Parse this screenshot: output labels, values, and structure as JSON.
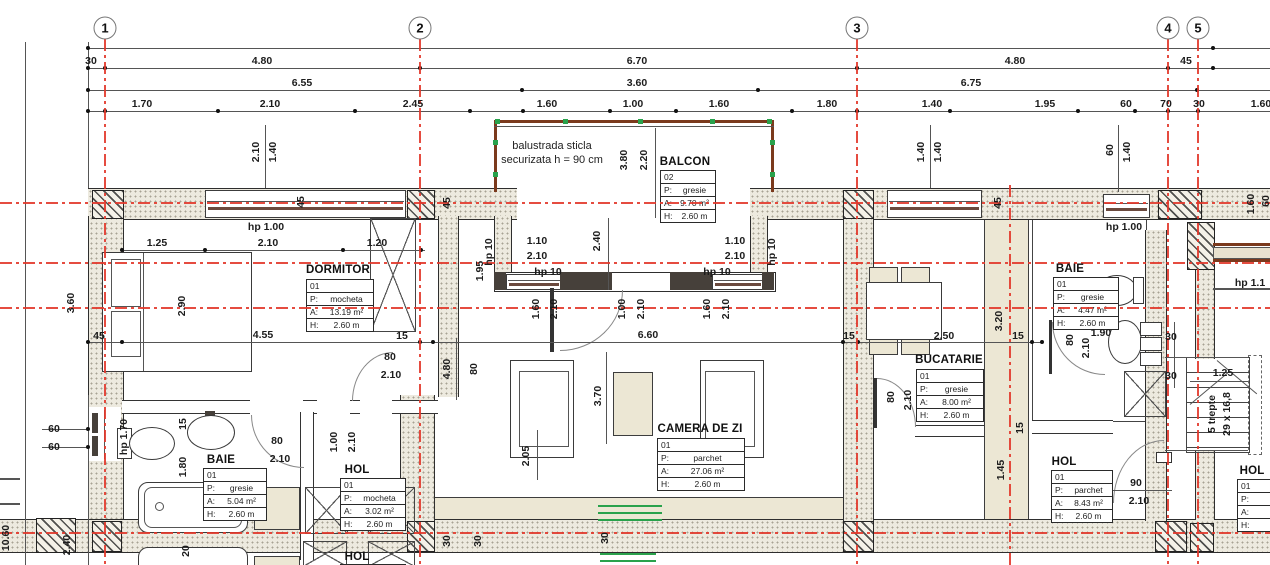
{
  "colors": {
    "axis": "#e2382b",
    "balustrade": "#7b3a1d",
    "green": "#2aa24c",
    "beige": "#ece7d4"
  },
  "grid_bubbles": [
    [
      "1",
      105
    ],
    [
      "2",
      420
    ],
    [
      "3",
      857
    ],
    [
      "4",
      1168
    ],
    [
      "5",
      1198
    ]
  ],
  "axes": {
    "v": [
      {
        "x": 105,
        "t": 39
      },
      {
        "x": 420,
        "t": 39
      },
      {
        "x": 857,
        "t": 39
      },
      {
        "x": 1010,
        "t": 185
      },
      {
        "x": 1168,
        "t": 39
      },
      {
        "x": 1198,
        "t": 39
      }
    ],
    "h": [
      203,
      263,
      308,
      533
    ]
  },
  "dim_rows": [
    {
      "y": 48,
      "dots": [
        88,
        1213
      ],
      "labels": []
    },
    {
      "y": 68,
      "dots": [
        88,
        105,
        420,
        857,
        1168,
        1213
      ],
      "labels": [
        [
          "30",
          91
        ],
        [
          "4.80",
          262
        ],
        [
          "6.70",
          637
        ],
        [
          "4.80",
          1015
        ],
        [
          "45",
          1186
        ]
      ]
    },
    {
      "y": 90,
      "dots": [
        88,
        522,
        758,
        1197
      ],
      "labels": [
        [
          "6.55",
          302
        ],
        [
          "3.60",
          637
        ],
        [
          "6.75",
          971
        ]
      ]
    },
    {
      "y": 111,
      "dots": [
        88,
        105,
        218,
        355,
        470,
        523,
        610,
        676,
        792,
        857,
        950,
        1078,
        1135,
        1168,
        1198
      ],
      "labels": [
        [
          "1.70",
          142
        ],
        [
          "2.10",
          270
        ],
        [
          "2.45",
          413
        ],
        [
          "1.60",
          547
        ],
        [
          "1.00",
          633
        ],
        [
          "1.60",
          719
        ],
        [
          "1.80",
          827
        ],
        [
          "1.40",
          932
        ],
        [
          "1.95",
          1045
        ],
        [
          "60",
          1126
        ],
        [
          "70",
          1166
        ],
        [
          "30",
          1199
        ],
        [
          "1.60",
          1261
        ]
      ]
    }
  ],
  "extra_dots": [
    [
      122,
      250
    ],
    [
      205,
      250
    ],
    [
      343,
      250
    ],
    [
      421,
      250
    ],
    [
      88,
      342
    ],
    [
      122,
      342
    ],
    [
      420,
      342
    ],
    [
      433,
      342
    ],
    [
      843,
      342
    ],
    [
      858,
      342
    ],
    [
      1032,
      342
    ],
    [
      1042,
      342
    ],
    [
      88,
      429
    ],
    [
      88,
      447
    ]
  ],
  "labels": [
    [
      "hp 1.00",
      266,
      227,
      0
    ],
    [
      "hp 1.00",
      1124,
      227,
      0
    ],
    [
      "1.25",
      157,
      243,
      0
    ],
    [
      "2.10",
      268,
      243,
      0
    ],
    [
      "1.20",
      377,
      243,
      0
    ],
    [
      "1.10",
      537,
      241,
      0
    ],
    [
      "2.10",
      537,
      256,
      0
    ],
    [
      "hp 10",
      548,
      272,
      0
    ],
    [
      "1.10",
      735,
      241,
      0
    ],
    [
      "2.10",
      735,
      256,
      0
    ],
    [
      "hp 10",
      717,
      272,
      0
    ],
    [
      "6.60",
      648,
      335,
      0
    ],
    [
      "45",
      99,
      336,
      0
    ],
    [
      "4.55",
      263,
      335,
      0
    ],
    [
      "15",
      402,
      336,
      0
    ],
    [
      "15",
      849,
      336,
      0
    ],
    [
      "2.50",
      944,
      336,
      0
    ],
    [
      "15",
      1018,
      336,
      0
    ],
    [
      "80",
      390,
      357,
      0
    ],
    [
      "2.10",
      391,
      375,
      0
    ],
    [
      "80",
      277,
      441,
      0
    ],
    [
      "2.10",
      280,
      459,
      0
    ],
    [
      "60",
      54,
      429,
      0
    ],
    [
      "60",
      54,
      447,
      0
    ],
    [
      "1.90",
      1101,
      333,
      0
    ],
    [
      "30",
      1171,
      337,
      0
    ],
    [
      "30",
      1171,
      376,
      0
    ],
    [
      "1.25",
      1223,
      373,
      0
    ],
    [
      "90",
      1136,
      483,
      0
    ],
    [
      "2.10",
      1139,
      501,
      0
    ],
    [
      "hp 1.1",
      1250,
      283,
      0
    ],
    [
      "2.10",
      256,
      152,
      1
    ],
    [
      "1.40",
      273,
      152,
      1
    ],
    [
      "3.80",
      624,
      160,
      1
    ],
    [
      "2.20",
      644,
      160,
      1
    ],
    [
      "2.40",
      597,
      241,
      1
    ],
    [
      "1.95",
      480,
      271,
      1
    ],
    [
      "hp 10",
      489,
      252,
      1
    ],
    [
      "hp 10",
      772,
      252,
      1
    ],
    [
      "1.60",
      536,
      309,
      1
    ],
    [
      "2.10",
      554,
      309,
      1
    ],
    [
      "1.00",
      622,
      309,
      1
    ],
    [
      "2.10",
      641,
      309,
      1
    ],
    [
      "1.60",
      707,
      309,
      1
    ],
    [
      "2.10",
      726,
      309,
      1
    ],
    [
      "3.70",
      598,
      396,
      1
    ],
    [
      "4.80",
      447,
      369,
      1
    ],
    [
      "80",
      474,
      369,
      1
    ],
    [
      "2.05",
      526,
      456,
      1
    ],
    [
      "2.90",
      182,
      306,
      1
    ],
    [
      "45",
      301,
      202,
      1
    ],
    [
      "45",
      447,
      203,
      1
    ],
    [
      "45",
      998,
      203,
      1
    ],
    [
      "1.40",
      921,
      152,
      1
    ],
    [
      "1.40",
      938,
      152,
      1
    ],
    [
      "60",
      1110,
      150,
      1
    ],
    [
      "1.40",
      1127,
      152,
      1
    ],
    [
      "1.60",
      1251,
      204,
      1
    ],
    [
      "60",
      1266,
      201,
      1
    ],
    [
      "3.60",
      71,
      303,
      1
    ],
    [
      "2.40",
      67,
      545,
      1
    ],
    [
      "10.60",
      6,
      538,
      1
    ],
    [
      "hp 1.70",
      124,
      437,
      1
    ],
    [
      "15",
      183,
      424,
      1
    ],
    [
      "1.80",
      183,
      467,
      1
    ],
    [
      "20",
      186,
      551,
      1
    ],
    [
      "1.00",
      334,
      442,
      1
    ],
    [
      "2.10",
      352,
      442,
      1
    ],
    [
      "80",
      891,
      397,
      1
    ],
    [
      "2.10",
      908,
      400,
      1
    ],
    [
      "3.20",
      999,
      321,
      1
    ],
    [
      "1.45",
      1001,
      470,
      1
    ],
    [
      "15",
      1020,
      428,
      1
    ],
    [
      "80",
      1070,
      340,
      1
    ],
    [
      "2.10",
      1086,
      348,
      1
    ],
    [
      "5 trepte",
      1212,
      414,
      1
    ],
    [
      "29 x 16,8",
      1227,
      414,
      1
    ],
    [
      "30",
      447,
      541,
      1
    ],
    [
      "30",
      478,
      541,
      1
    ],
    [
      "30",
      605,
      538,
      1
    ]
  ],
  "notes": [
    [
      "balustrada sticla",
      552,
      146
    ],
    [
      "securizata h = 90 cm",
      552,
      160
    ]
  ],
  "rooms": [
    {
      "name": "DORMITOR",
      "nx": 338,
      "ny": 270,
      "tx": 306,
      "ty": 279,
      "w": 66,
      "rows": [
        [
          "01",
          ""
        ],
        [
          "P:",
          "mocheta"
        ],
        [
          "A:",
          "13.19 m²"
        ],
        [
          "H:",
          "2.60 m"
        ]
      ]
    },
    {
      "name": "BALCON",
      "nx": 685,
      "ny": 162,
      "tx": 660,
      "ty": 170,
      "w": 54,
      "rows": [
        [
          "02",
          ""
        ],
        [
          "P:",
          "gresie"
        ],
        [
          "A:",
          "9.70 m²"
        ],
        [
          "H:",
          "2.60 m"
        ]
      ]
    },
    {
      "name": "CAMERA DE ZI",
      "nx": 700,
      "ny": 429,
      "tx": 657,
      "ty": 438,
      "w": 86,
      "rows": [
        [
          "01",
          ""
        ],
        [
          "P:",
          "parchet"
        ],
        [
          "A:",
          "27.06 m²"
        ],
        [
          "H:",
          "2.60 m"
        ]
      ]
    },
    {
      "name": "BUCATARIE",
      "nx": 949,
      "ny": 360,
      "tx": 916,
      "ty": 369,
      "w": 66,
      "rows": [
        [
          "01",
          ""
        ],
        [
          "P:",
          "gresie"
        ],
        [
          "A:",
          "8.00 m²"
        ],
        [
          "H:",
          "2.60 m"
        ]
      ]
    },
    {
      "name": "BAIE",
      "nx": 221,
      "ny": 460,
      "tx": 203,
      "ty": 468,
      "w": 62,
      "rows": [
        [
          "01",
          ""
        ],
        [
          "P:",
          "gresie"
        ],
        [
          "A:",
          "5.04 m²"
        ],
        [
          "H:",
          "2.60 m"
        ]
      ]
    },
    {
      "name": "HOL",
      "nx": 357,
      "ny": 470,
      "tx": 340,
      "ty": 478,
      "w": 64,
      "rows": [
        [
          "01",
          ""
        ],
        [
          "P:",
          "mocheta"
        ],
        [
          "A:",
          "3.02 m²"
        ],
        [
          "H:",
          "2.60 m"
        ]
      ]
    },
    {
      "name": "BAIE",
      "nx": 1070,
      "ny": 269,
      "tx": 1053,
      "ty": 277,
      "w": 64,
      "rows": [
        [
          "01",
          ""
        ],
        [
          "P:",
          "gresie"
        ],
        [
          "A:",
          "4.47 m²"
        ],
        [
          "H:",
          "2.60 m"
        ]
      ]
    },
    {
      "name": "HOL",
      "nx": 1064,
      "ny": 462,
      "tx": 1051,
      "ty": 470,
      "w": 60,
      "rows": [
        [
          "01",
          ""
        ],
        [
          "P:",
          "parchet"
        ],
        [
          "A:",
          "8.43 m²"
        ],
        [
          "H:",
          "2.60 m"
        ]
      ]
    },
    {
      "name": "HOL",
      "nx": 1252,
      "ny": 471,
      "tx": 1237,
      "ty": 479,
      "w": 64,
      "rows": [
        [
          "01",
          ""
        ],
        [
          "P:",
          ""
        ],
        [
          "A:",
          "18."
        ],
        [
          "H:",
          "2."
        ]
      ]
    },
    {
      "name": "HOL",
      "nx": 357,
      "ny": 557,
      "tx": 340,
      "ty": 564,
      "w": 64,
      "rows": [
        [
          "01",
          ""
        ]
      ]
    }
  ]
}
